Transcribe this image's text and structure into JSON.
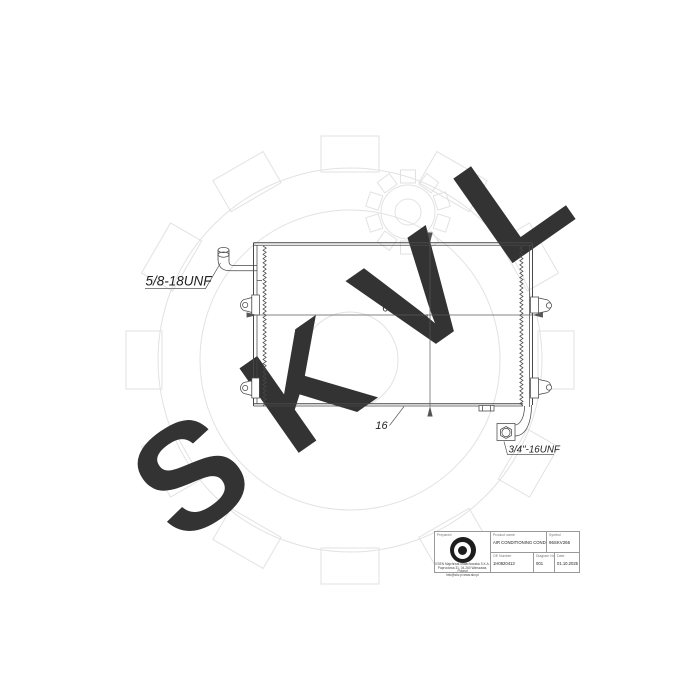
{
  "drawing": {
    "inlet_thread_label": "5/8-18UNF",
    "outlet_thread_label": "3/4\"-16UNF",
    "dimensions": {
      "width": "610",
      "height": "341",
      "depth": "16"
    }
  },
  "watermark": {
    "letters": [
      "S",
      "K",
      "V",
      "L"
    ]
  },
  "title_block": {
    "prepared_label": "Prepared",
    "product_name_label": "Product name",
    "product_name_value": "AIR CONDITIONING CONDENSER",
    "symbol_label": "Symbol",
    "symbol_value": "96SKV266",
    "oe_number_label": "OE Number",
    "oe_number_value": "1H0820413",
    "diagram_no_label": "Diagram No.",
    "diagram_no_value": "001",
    "date_label": "Date",
    "date_value": "01.10.2025",
    "company_lines": [
      "ESEN Majchrzak Małachowska S.K.A.",
      "Paprociowa 31, 04-260 Warszawa, Poland",
      "info@skv.pl  www.skv.pl"
    ]
  }
}
